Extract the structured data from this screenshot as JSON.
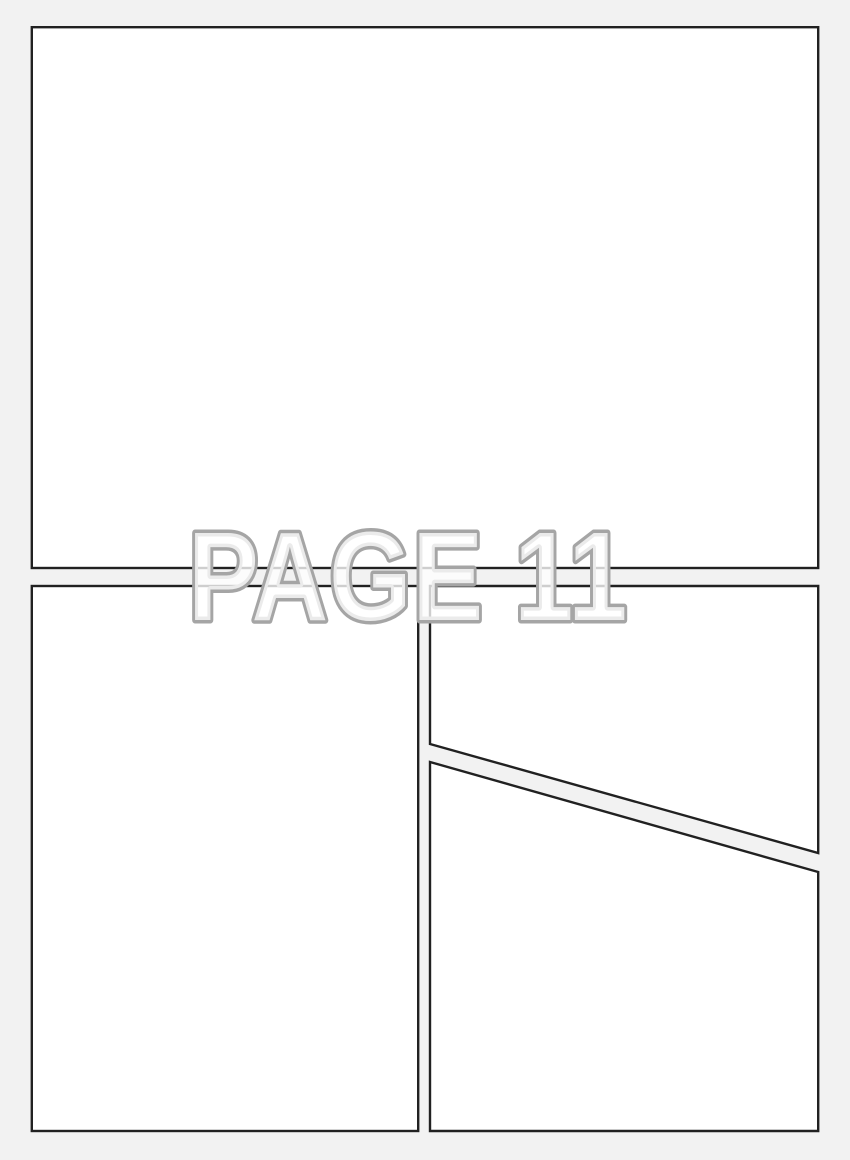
{
  "page": {
    "label": "PAGE 11"
  },
  "panels": [
    {
      "id": "panel-1",
      "shape": "rectangle",
      "position": "top-full-width"
    },
    {
      "id": "panel-2",
      "shape": "rectangle",
      "position": "bottom-left"
    },
    {
      "id": "panel-3",
      "shape": "quadrilateral-diagonal-bottom",
      "position": "top-right"
    },
    {
      "id": "panel-4",
      "shape": "quadrilateral-diagonal-top",
      "position": "bottom-right"
    }
  ],
  "colors": {
    "sheet_background": "#f2f2f2",
    "panel_fill": "#ffffff",
    "panel_border": "#212121",
    "label_outline": "#a5a5a5",
    "label_fill": "rgba(255,255,255,0.78)"
  }
}
